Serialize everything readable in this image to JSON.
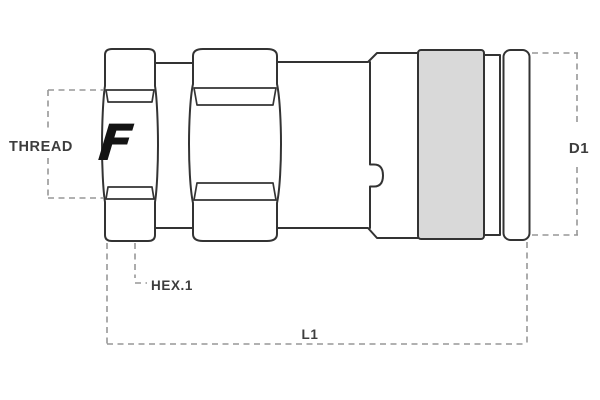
{
  "diagram": {
    "labels": {
      "thread": "THREAD",
      "hex1": "HEX.1",
      "l1": "L1",
      "d1": "D1"
    },
    "logo_letter": "F",
    "colors": {
      "outline": "#333333",
      "dashed_line": "#979797",
      "label_text": "#3d3d3d",
      "sleeve_fill": "#d9d9d9",
      "logo_fill": "#141414",
      "background": "#ffffff"
    }
  }
}
